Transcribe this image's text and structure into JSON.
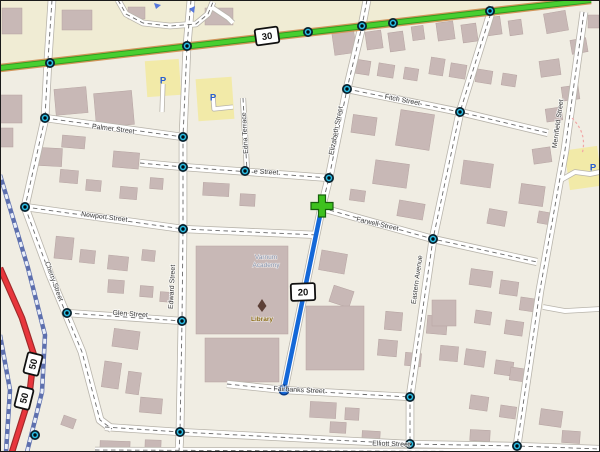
{
  "map": {
    "canvas": {
      "width": 600,
      "height": 452,
      "background": "#f0ede3",
      "upper_band_fill": "#f0ecd4",
      "border_color": "#1a1a1a"
    },
    "palette": {
      "building": "#c8b8b6",
      "building_stroke": "#b5a3a1",
      "street_fill": "#ffffff",
      "street_casing": "#b8b4ab",
      "street_dash": "#6a6a6a",
      "highway_green": "#47cf30",
      "highway_green_edge": "#2f9a1e",
      "highway_under": "#d1955a",
      "railway": "#5d6fae",
      "railway_dash": "#e9eef9",
      "trunk_red": "#e8363c",
      "trunk_casing": "#9e2a2a",
      "route_blue": "#1468d8",
      "route_end": "#0a3a85",
      "route_start_green": "#3ec11f",
      "route_start_edge": "#17610d",
      "marker_outer": "#09222e",
      "marker_ring": "#2bc0e8",
      "marker_core": "#000b10",
      "parking_lot": "#f2eaa8",
      "parking_p": "#2a5fd0",
      "label": "#3a3a3a",
      "poi_blue_gray": "#8694ad",
      "library_brown": "#8a6a14",
      "library_icon": "#5d4037",
      "arrow_blue": "#5577dd",
      "trail_pink": "#f2a6a6"
    },
    "shields": [
      {
        "label": "30",
        "x": 267,
        "y": 36,
        "rot": -8,
        "w": 23,
        "h": 16
      },
      {
        "label": "20",
        "x": 303,
        "y": 292,
        "rot": -2,
        "w": 24,
        "h": 17
      },
      {
        "label": "50",
        "x": 33,
        "y": 364,
        "rot": -76,
        "w": 21,
        "h": 15
      },
      {
        "label": "50",
        "x": 24,
        "y": 398,
        "rot": -76,
        "w": 21,
        "h": 15
      }
    ],
    "street_labels": [
      {
        "text": "Palmer Street",
        "x": 113,
        "y": 131,
        "rot": 7
      },
      {
        "text": "e Street",
        "x": 266,
        "y": 174,
        "rot": 3
      },
      {
        "text": "Edna Terrace",
        "x": 247,
        "y": 133,
        "rot": -93
      },
      {
        "text": "Fitch Street",
        "x": 402,
        "y": 102,
        "rot": 11
      },
      {
        "text": "Elizabeth Street",
        "x": 338,
        "y": 131,
        "rot": -79
      },
      {
        "text": "Newport Street",
        "x": 104,
        "y": 219,
        "rot": 7
      },
      {
        "text": "Farwell Street",
        "x": 377,
        "y": 226,
        "rot": 13
      },
      {
        "text": "Eastern Avenue",
        "x": 419,
        "y": 280,
        "rot": -82
      },
      {
        "text": "Merrifield Street",
        "x": 560,
        "y": 124,
        "rot": -82
      },
      {
        "text": "Cherry Street",
        "x": 52,
        "y": 282,
        "rot": 70
      },
      {
        "text": "Edward Street",
        "x": 174,
        "y": 287,
        "rot": -87
      },
      {
        "text": "Glen Street",
        "x": 130,
        "y": 316,
        "rot": 4
      },
      {
        "text": "Fairbanks Street",
        "x": 299,
        "y": 392,
        "rot": 3
      },
      {
        "text": "Elliott Street",
        "x": 391,
        "y": 446,
        "rot": 2
      }
    ],
    "poi": {
      "academy_line1": "Varnum",
      "academy_line2": "Academy",
      "academy_x": 266,
      "academy_y1": 259,
      "academy_y2": 267,
      "library": "Library",
      "library_x": 262,
      "library_y": 321,
      "parking_letter": "P"
    },
    "parking_icons": [
      [
        163,
        80
      ],
      [
        213,
        97
      ],
      [
        593,
        167
      ]
    ],
    "parking_lots": [
      [
        146,
        60,
        34,
        36,
        -4
      ],
      [
        197,
        78,
        36,
        42,
        -4
      ],
      [
        567,
        148,
        33,
        40,
        -8
      ]
    ],
    "green_road": {
      "points": [
        [
          0,
          68
        ],
        [
          591,
          0
        ]
      ]
    },
    "railways": [
      [
        [
          0,
          175
        ],
        [
          28,
          268
        ],
        [
          45,
          335
        ],
        [
          42,
          392
        ],
        [
          27,
          452
        ]
      ],
      [
        [
          0,
          335
        ],
        [
          10,
          390
        ],
        [
          6,
          452
        ]
      ]
    ],
    "red_roads": [
      [
        [
          0,
          268
        ],
        [
          22,
          318
        ],
        [
          34,
          355
        ],
        [
          29,
          398
        ],
        [
          12,
          452
        ]
      ]
    ],
    "streets": [
      {
        "name": "v1-upper",
        "points": [
          [
            52,
            0
          ],
          [
            48,
            60
          ],
          [
            45,
            118
          ]
        ],
        "width": 7
      },
      {
        "name": "v1-mid",
        "points": [
          [
            45,
            118
          ],
          [
            25,
            207
          ]
        ],
        "width": 7
      },
      {
        "name": "cherry",
        "points": [
          [
            25,
            207
          ],
          [
            50,
            275
          ],
          [
            82,
            352
          ],
          [
            100,
            420
          ],
          [
            112,
            429
          ]
        ],
        "width": 7
      },
      {
        "name": "edward",
        "points": [
          [
            191,
            0
          ],
          [
            187,
            46
          ],
          [
            183,
            137
          ],
          [
            183,
            229
          ],
          [
            182,
            321
          ],
          [
            180,
            432
          ],
          [
            179,
            452
          ]
        ],
        "width": 7
      },
      {
        "name": "elizabeth",
        "points": [
          [
            367,
            0
          ],
          [
            362,
            26
          ],
          [
            347,
            89
          ],
          [
            329,
            178
          ],
          [
            322,
            206
          ],
          [
            284,
            390
          ]
        ],
        "width": 7
      },
      {
        "name": "eastern",
        "points": [
          [
            493,
            6
          ],
          [
            460,
            112
          ],
          [
            433,
            239
          ],
          [
            410,
            397
          ],
          [
            410,
            444
          ]
        ],
        "width": 7
      },
      {
        "name": "merrifield",
        "points": [
          [
            584,
            12
          ],
          [
            565,
            150
          ],
          [
            540,
            290
          ],
          [
            517,
            446
          ],
          [
            522,
            452
          ]
        ],
        "width": 7
      },
      {
        "name": "edna",
        "points": [
          [
            243,
            98
          ],
          [
            247,
            171
          ]
        ],
        "width": 4.5
      },
      {
        "name": "palmer",
        "points": [
          [
            45,
            118
          ],
          [
            183,
            137
          ]
        ],
        "width": 6.5
      },
      {
        "name": "e-street",
        "points": [
          [
            140,
            163
          ],
          [
            183,
            167
          ],
          [
            329,
            178
          ]
        ],
        "width": 6.5
      },
      {
        "name": "fitch",
        "points": [
          [
            347,
            89
          ],
          [
            460,
            112
          ],
          [
            548,
            133
          ]
        ],
        "width": 6.5
      },
      {
        "name": "newport",
        "points": [
          [
            25,
            207
          ],
          [
            183,
            229
          ],
          [
            318,
            235
          ]
        ],
        "width": 6.5
      },
      {
        "name": "farwell",
        "points": [
          [
            322,
            208
          ],
          [
            433,
            239
          ],
          [
            537,
            262
          ]
        ],
        "width": 6.5
      },
      {
        "name": "glen",
        "points": [
          [
            67,
            313
          ],
          [
            182,
            321
          ]
        ],
        "width": 6.5
      },
      {
        "name": "fairbanks",
        "points": [
          [
            227,
            384
          ],
          [
            284,
            390
          ],
          [
            410,
            397
          ]
        ],
        "width": 6.5
      },
      {
        "name": "elliott",
        "points": [
          [
            105,
            427
          ],
          [
            180,
            432
          ],
          [
            410,
            444
          ],
          [
            517,
            446
          ],
          [
            600,
            449
          ]
        ],
        "width": 6.5
      },
      {
        "name": "bottom-2",
        "points": [
          [
            95,
            450
          ],
          [
            600,
            452
          ]
        ],
        "width": 5
      },
      {
        "name": "top-loop",
        "points": [
          [
            118,
            0
          ],
          [
            126,
            14
          ],
          [
            143,
            23
          ],
          [
            170,
            26
          ],
          [
            196,
            24
          ],
          [
            208,
            14
          ],
          [
            213,
            2
          ]
        ],
        "width": 5
      },
      {
        "name": "loop-spur",
        "points": [
          [
            210,
            6
          ],
          [
            228,
            18
          ],
          [
            233,
            23
          ]
        ],
        "width": 4
      },
      {
        "name": "p-access-1",
        "points": [
          [
            163,
            84
          ],
          [
            162,
            112
          ]
        ],
        "width": 3.5
      },
      {
        "name": "p-access-2",
        "points": [
          [
            213,
            97
          ],
          [
            214,
            109
          ],
          [
            233,
            107
          ]
        ],
        "width": 3.5
      },
      {
        "name": "m-access-1",
        "points": [
          [
            561,
            180
          ],
          [
            575,
            172
          ],
          [
            590,
            174
          ],
          [
            600,
            172
          ]
        ],
        "width": 4
      },
      {
        "name": "m-access-2",
        "points": [
          [
            543,
            307
          ],
          [
            565,
            311
          ],
          [
            600,
            309
          ]
        ],
        "width": 4
      }
    ],
    "route": {
      "line": [
        [
          322,
          206
        ],
        [
          284,
          390
        ]
      ],
      "start": [
        322,
        206
      ],
      "end": [
        284,
        390
      ]
    },
    "markers": [
      [
        50,
        63
      ],
      [
        187,
        46
      ],
      [
        308,
        32
      ],
      [
        362,
        26
      ],
      [
        393,
        23
      ],
      [
        490,
        11
      ],
      [
        45,
        118
      ],
      [
        25,
        207
      ],
      [
        67,
        313
      ],
      [
        183,
        137
      ],
      [
        183,
        167
      ],
      [
        183,
        229
      ],
      [
        182,
        321
      ],
      [
        180,
        432
      ],
      [
        347,
        89
      ],
      [
        329,
        178
      ],
      [
        245,
        171
      ],
      [
        460,
        112
      ],
      [
        433,
        239
      ],
      [
        410,
        397
      ],
      [
        410,
        444
      ],
      [
        517,
        446
      ],
      [
        35,
        435
      ]
    ],
    "arrows": [
      "M154,3 l7,2 -5,4 z",
      "M195,6 l-1,7 -5,-4 z"
    ],
    "trail": "M 572,118 C 582,128 586,140 582,154",
    "buildings": [
      [
        2,
        8,
        20,
        26,
        0
      ],
      [
        62,
        10,
        30,
        20,
        0
      ],
      [
        128,
        7,
        17,
        12,
        0
      ],
      [
        205,
        8,
        28,
        17,
        0
      ],
      [
        545,
        12,
        22,
        20,
        -10
      ],
      [
        571,
        39,
        16,
        14,
        -10
      ],
      [
        588,
        15,
        11,
        13,
        0
      ],
      [
        333,
        28,
        22,
        26,
        -8
      ],
      [
        366,
        31,
        16,
        18,
        -8
      ],
      [
        389,
        32,
        15,
        19,
        -8
      ],
      [
        412,
        26,
        12,
        14,
        -8
      ],
      [
        437,
        22,
        17,
        18,
        -8
      ],
      [
        462,
        24,
        15,
        18,
        -8
      ],
      [
        486,
        17,
        15,
        18,
        -8
      ],
      [
        509,
        20,
        13,
        15,
        -8
      ],
      [
        0,
        95,
        22,
        28,
        0
      ],
      [
        55,
        88,
        32,
        26,
        -5
      ],
      [
        95,
        92,
        38,
        34,
        -5
      ],
      [
        0,
        128,
        13,
        19,
        0
      ],
      [
        38,
        148,
        24,
        18,
        3
      ],
      [
        62,
        136,
        23,
        12,
        5
      ],
      [
        113,
        152,
        26,
        16,
        5
      ],
      [
        150,
        178,
        13,
        11,
        4
      ],
      [
        203,
        183,
        26,
        13,
        3
      ],
      [
        240,
        194,
        15,
        12,
        3
      ],
      [
        60,
        170,
        18,
        13,
        5
      ],
      [
        86,
        180,
        15,
        11,
        5
      ],
      [
        120,
        187,
        17,
        12,
        5
      ],
      [
        55,
        237,
        18,
        22,
        6
      ],
      [
        80,
        250,
        15,
        13,
        6
      ],
      [
        108,
        256,
        20,
        14,
        6
      ],
      [
        142,
        250,
        13,
        11,
        6
      ],
      [
        108,
        280,
        16,
        13,
        4
      ],
      [
        140,
        286,
        13,
        11,
        4
      ],
      [
        160,
        292,
        12,
        10,
        4
      ],
      [
        113,
        330,
        26,
        18,
        8
      ],
      [
        103,
        362,
        17,
        26,
        8
      ],
      [
        127,
        372,
        13,
        22,
        8
      ],
      [
        140,
        398,
        22,
        15,
        5
      ],
      [
        100,
        441,
        30,
        9,
        2
      ],
      [
        145,
        440,
        16,
        10,
        2
      ],
      [
        62,
        417,
        13,
        10,
        20
      ],
      [
        196,
        246,
        92,
        88,
        0
      ],
      [
        205,
        338,
        74,
        44,
        0
      ],
      [
        320,
        252,
        26,
        20,
        10
      ],
      [
        331,
        288,
        21,
        17,
        18
      ],
      [
        306,
        306,
        58,
        64,
        0
      ],
      [
        352,
        116,
        24,
        18,
        8
      ],
      [
        398,
        112,
        34,
        36,
        9
      ],
      [
        374,
        162,
        34,
        24,
        8
      ],
      [
        398,
        202,
        26,
        16,
        10
      ],
      [
        350,
        190,
        15,
        11,
        8
      ],
      [
        352,
        60,
        18,
        14,
        9
      ],
      [
        378,
        64,
        16,
        13,
        9
      ],
      [
        404,
        68,
        14,
        12,
        9
      ],
      [
        430,
        58,
        14,
        17,
        9
      ],
      [
        450,
        64,
        16,
        14,
        9
      ],
      [
        476,
        70,
        16,
        13,
        9
      ],
      [
        502,
        74,
        14,
        12,
        9
      ],
      [
        462,
        162,
        30,
        24,
        8
      ],
      [
        520,
        185,
        24,
        20,
        8
      ],
      [
        488,
        210,
        18,
        15,
        10
      ],
      [
        538,
        212,
        14,
        12,
        10
      ],
      [
        540,
        60,
        20,
        16,
        -8
      ],
      [
        562,
        86,
        17,
        14,
        -8
      ],
      [
        546,
        108,
        16,
        13,
        -8
      ],
      [
        533,
        148,
        18,
        15,
        -8
      ],
      [
        470,
        270,
        22,
        16,
        8
      ],
      [
        500,
        281,
        18,
        14,
        8
      ],
      [
        520,
        298,
        16,
        13,
        8
      ],
      [
        475,
        311,
        16,
        13,
        8
      ],
      [
        505,
        321,
        18,
        14,
        8
      ],
      [
        465,
        350,
        20,
        16,
        8
      ],
      [
        495,
        361,
        18,
        14,
        8
      ],
      [
        510,
        368,
        16,
        13,
        8
      ],
      [
        470,
        396,
        18,
        14,
        8
      ],
      [
        500,
        406,
        16,
        12,
        8
      ],
      [
        540,
        410,
        22,
        16,
        8
      ],
      [
        562,
        431,
        18,
        12,
        4
      ],
      [
        385,
        312,
        17,
        18,
        5
      ],
      [
        427,
        316,
        20,
        18,
        5
      ],
      [
        432,
        300,
        24,
        26,
        0
      ],
      [
        378,
        340,
        19,
        16,
        5
      ],
      [
        405,
        353,
        16,
        13,
        5
      ],
      [
        440,
        346,
        18,
        15,
        5
      ],
      [
        310,
        402,
        26,
        16,
        3
      ],
      [
        345,
        408,
        14,
        12,
        3
      ],
      [
        330,
        422,
        16,
        11,
        3
      ],
      [
        362,
        431,
        18,
        11,
        3
      ],
      [
        470,
        430,
        20,
        11,
        3
      ]
    ]
  }
}
